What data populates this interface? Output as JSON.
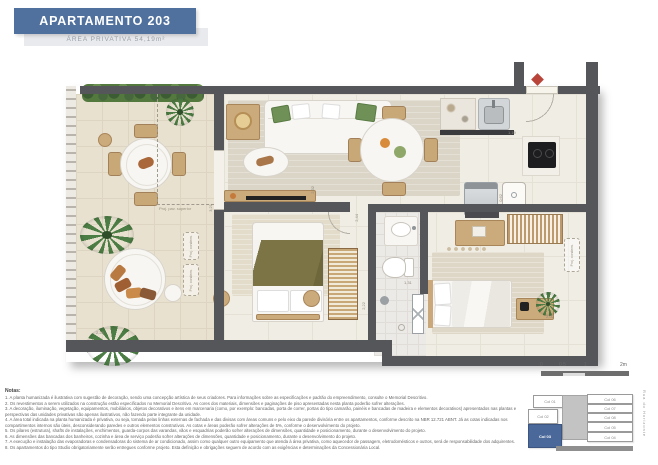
{
  "header": {
    "title": "APARTAMENTO 203",
    "subtitle": "ÁREA PRIVATIVA 54,19m²"
  },
  "colors": {
    "banner": "#50709e",
    "keyplan_highlight": "#4a6899",
    "entrance_marker": "#b9453a",
    "wall": "#55565a"
  },
  "plan": {
    "annotations": {
      "proj_pav_superior": "Proj. pav. superior",
      "proj_condens": "Proj. condens."
    },
    "dimensions": [
      "2,28",
      "3,21",
      "2,32",
      "2,44",
      "2,22",
      "1,31",
      "1,19",
      "0,62",
      "2,02"
    ]
  },
  "notes": {
    "heading": "Notas:",
    "items": [
      "1. A planta humanizada é ilustrativa com sugestão de decoração, sendo uma concepção artística de seus criadores. Para informações sobre as especificações e padrão do empreendimento, consulte o Memorial Descritivo.",
      "2. Os revestimentos a serem utilizados na construção estão especificados no Memorial Descritivo. As cores dos materiais, dimensões e paginações de piso apresentadas nesta planta poderão sofrer alterações.",
      "3. A decoração, iluminação, vegetação, equipamentos, mobiliários, objetos decorativos e itens em marcenaria (como, por exemplo: bancadas, porta de correr, portas do tipo camarão, painéis e bancadas de madeira e elementos decorativos) apresentados nas plantas e perspectivas das unidades privativas são apenas ilustrativos, não fazendo parte integrante da unidade.",
      "4. A área total indicada na planta humanizada é privativa, ou seja, tomada pelas linhas externas de fachada e das divisas com áreas comuns e pelo eixo da parede divisória entre os apartamentos, conforme descrito na NBR 12.721 ABNT. Já as cotas indicadas nos compartimentos internos são úteis, desconsiderando paredes e outros elementos construtivos. As cotas e áreas poderão sofrer alterações de 5%, conforme o desenvolvimento do projeto.",
      "5. Os pilares (estrutura), shafts de instalações, enchimentos, guarda-corpos das varandas, vãos e esquadrias poderão sofrer alterações de dimensões, quantidade e posicionamento, durante o desenvolvimento do projeto.",
      "6. As dimensões das bancadas dos banheiros, cozinha e área de serviço poderão sofrer alterações de dimensões, quantidade e posicionamento, durante o desenvolvimento do projeto.",
      "7. A execução e instalação das evaporadoras e condensadoras do sistema de ar condicionado, assim como qualquer outro equipamento que atenda à área privativa, como aquecedor de passagem, eletrodomésticos e outros, será de responsabilidade dos adquirentes.",
      "8. Os apartamentos do tipo Studio obrigatoriamente serão entregues conforme projeto. Esta definição e obrigações seguem de acordo com as exigências e determinações da Concessionária Local."
    ]
  },
  "scalebar": {
    "ticks": [
      "0",
      "0.5",
      "1",
      "2m"
    ]
  },
  "keyplan": {
    "units_left": [
      "Col 01",
      "Col 02"
    ],
    "highlighted": "Col 03",
    "units_right": [
      "Col 06",
      "Col 07",
      "Col 08",
      "Col 05",
      "Col 04"
    ],
    "street": "Rua do Horizonte"
  }
}
